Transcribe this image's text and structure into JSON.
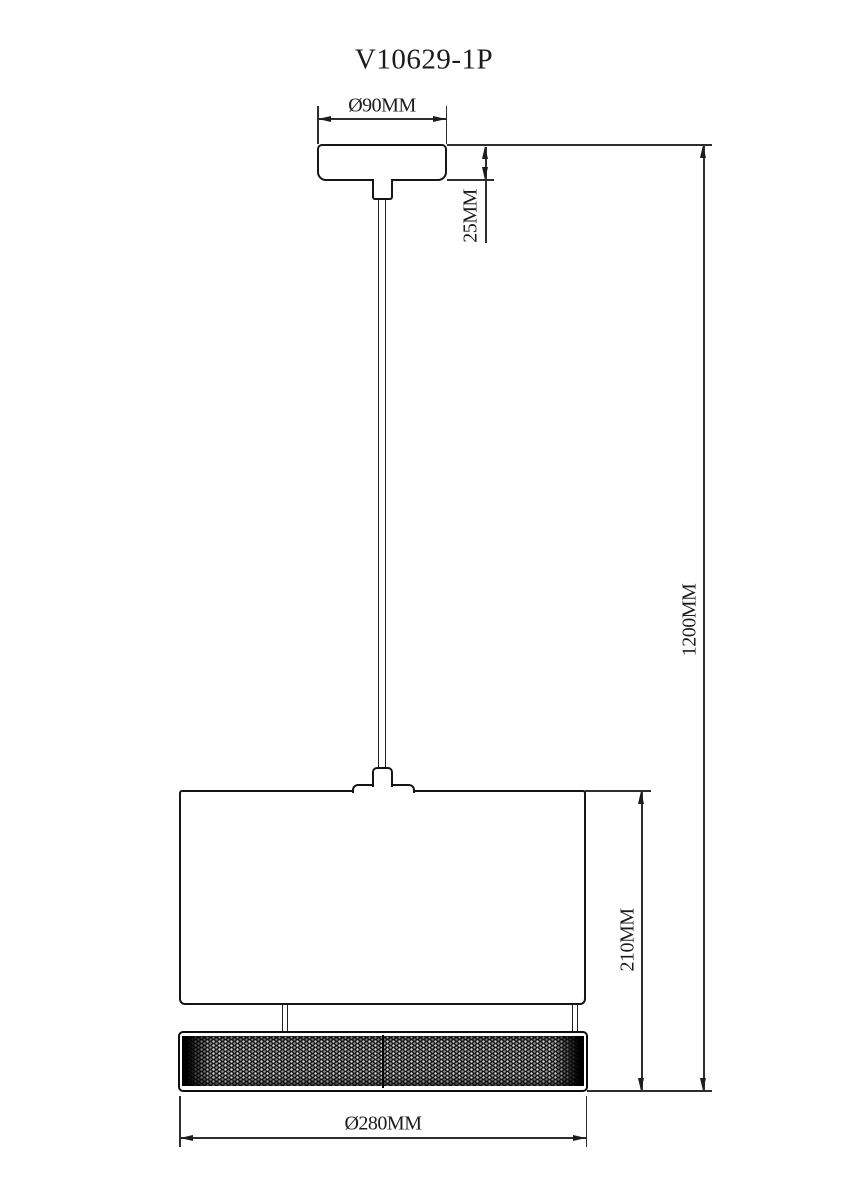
{
  "drawing": {
    "title": "V10629-1P",
    "type": "pendant-lamp-technical-drawing",
    "dimensions": {
      "canopy_diameter": "Ø90MM",
      "canopy_height": "25MM",
      "overall_height": "1200MM",
      "shade_height": "210MM",
      "shade_diameter": "Ø280MM"
    },
    "colors": {
      "line": "#1c1c1c",
      "background": "#ffffff",
      "mesh_fill": "#181818"
    }
  }
}
